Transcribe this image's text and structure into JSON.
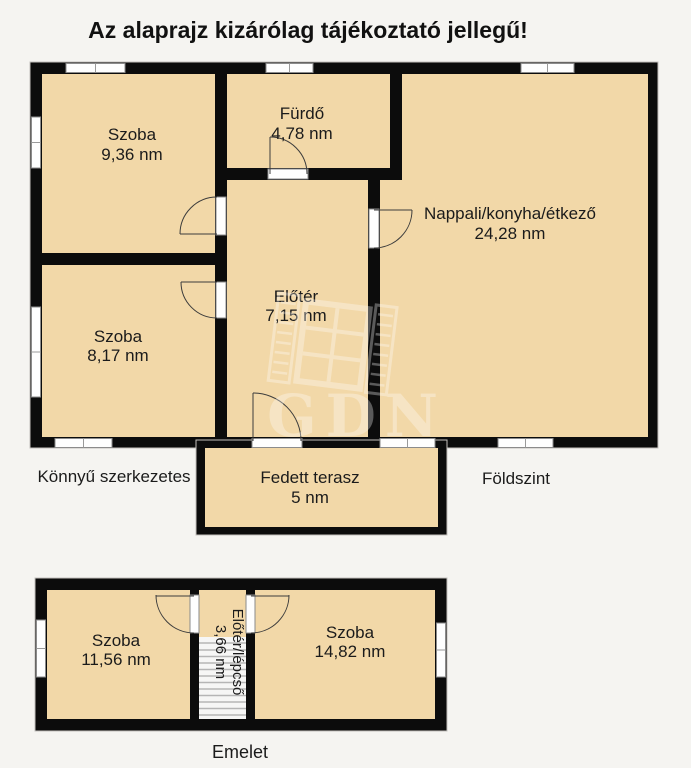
{
  "title": "Az alaprajz kizárólag tájékoztató jellegű!",
  "floors": {
    "ground": {
      "label": "Földszint",
      "note": "Könnyű szerkezetes",
      "rooms": {
        "szoba_936": {
          "name": "Szoba",
          "area": "9,36 nm"
        },
        "furdo": {
          "name": "Fürdő",
          "area": "4,78 nm"
        },
        "nappali": {
          "name": "Nappali/konyha/étkező",
          "area": "24,28 nm"
        },
        "eloter": {
          "name": "Előtér",
          "area": "7,15 nm"
        },
        "szoba_817": {
          "name": "Szoba",
          "area": "8,17 nm"
        },
        "fedett_terasz": {
          "name": "Fedett terasz",
          "area": "5 nm"
        }
      }
    },
    "upper": {
      "label": "Emelet",
      "rooms": {
        "szoba_1156": {
          "name": "Szoba",
          "area": "11,56 nm"
        },
        "eloter_lepcso": {
          "name": "Előtér/lépcső",
          "area": "3,66 nm"
        },
        "szoba_1482": {
          "name": "Szoba",
          "area": "14,82 nm"
        }
      }
    }
  },
  "watermark": {
    "text": "GDN"
  },
  "colors": {
    "background": "#f5f4f1",
    "wall": "#0c0c0c",
    "room_fill": "#f2d8a8",
    "window_fill": "#fefefe",
    "stair_stripe": "#b5b5b5",
    "watermark": "#ffffff",
    "text": "#1b1b1b"
  }
}
